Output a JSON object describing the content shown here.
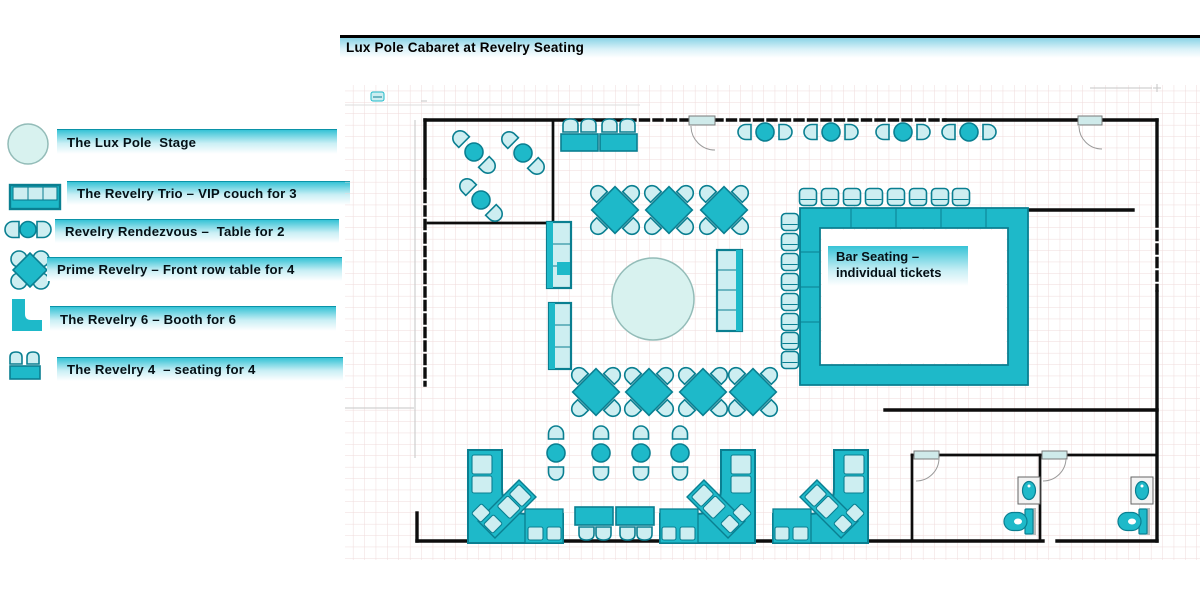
{
  "title": "Lux Pole Cabaret at Revelry Seating",
  "colors": {
    "teal": "#1eb9c9",
    "tealDark": "#0a7f91",
    "tealLight": "#cdeef1",
    "stage": "#d8f2ef",
    "stageStroke": "#93bcb8",
    "grid": "#efdada",
    "wall": "#0d0d0d",
    "gradTop": "#36c3d6",
    "gradMid": "#c9eff5"
  },
  "legend": {
    "items": [
      {
        "icon": "stage-circle-icon",
        "label": "The Lux Pole  Stage"
      },
      {
        "icon": "vip-couch-icon",
        "label": "The Revelry Trio – VIP couch for 3"
      },
      {
        "icon": "table-for-two-icon",
        "label": "Revelry Rendezvous –  Table for 2"
      },
      {
        "icon": "front-row-table-icon",
        "label": "Prime Revelry – Front row table for 4"
      },
      {
        "icon": "booth-icon",
        "label": "The Revelry 6 – Booth for 6"
      },
      {
        "icon": "bench-seating-icon",
        "label": "The Revelry 4  – seating for 4"
      }
    ]
  },
  "floorplan": {
    "bar_label": "Bar Seating –\nindividual tickets",
    "counts": {
      "front_row_tables_for_4": 7,
      "tables_for_2": 11,
      "vip_couches": 3,
      "booths_for_6": 3,
      "bench_seats_for_4": 4,
      "bar_stools": 16,
      "restrooms": 2
    }
  }
}
